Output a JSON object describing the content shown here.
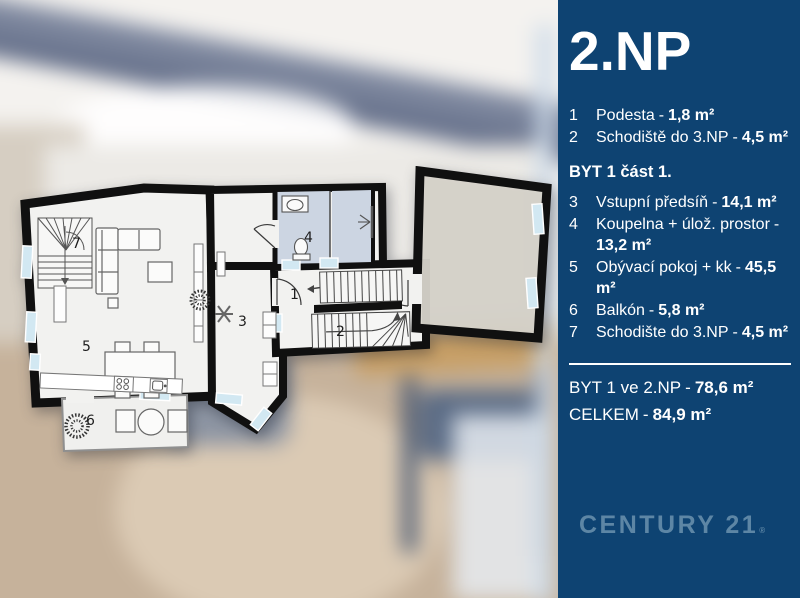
{
  "panel": {
    "title": "2.NP"
  },
  "legend": {
    "separator": "-",
    "common_rooms": [
      {
        "num": "1",
        "name": "Podesta",
        "area": "1,8 m²"
      },
      {
        "num": "2",
        "name": "Schodiště do 3.NP",
        "area": "4,5 m²"
      }
    ],
    "section_title": "BYT 1 část 1.",
    "apartment_rooms": [
      {
        "num": "3",
        "name": "Vstupní předsíň",
        "area": "14,1 m²"
      },
      {
        "num": "4",
        "name": "Koupelna + úlož. prostor",
        "area": "13,2 m²"
      },
      {
        "num": "5",
        "name": "Obývací pokoj + kk",
        "area": "45,5 m²"
      },
      {
        "num": "6",
        "name": "Balkón",
        "area": "5,8 m²"
      },
      {
        "num": "7",
        "name": "Schodište do 3.NP",
        "area": "4,5 m²"
      }
    ],
    "totals": [
      {
        "label": "BYT 1 ve 2.NP",
        "area": "78,6 m²"
      },
      {
        "label": "CELKEM",
        "area": "84,9 m²"
      }
    ]
  },
  "brand": {
    "name": "CENTURY 21",
    "mark": "®"
  },
  "floorplan": {
    "room_numbers": {
      "r1": "1",
      "r2": "2",
      "r3": "3",
      "r4": "4",
      "r5": "5",
      "r6": "6",
      "r7": "7"
    }
  },
  "colors": {
    "panel_bg": "#0e4372",
    "brand": "#5d86a5",
    "wall": "#101010",
    "room": "#f2f2f0",
    "bath": "#ccd5e2",
    "window": "#d2e8f2",
    "beige": "#d8d5cc"
  }
}
